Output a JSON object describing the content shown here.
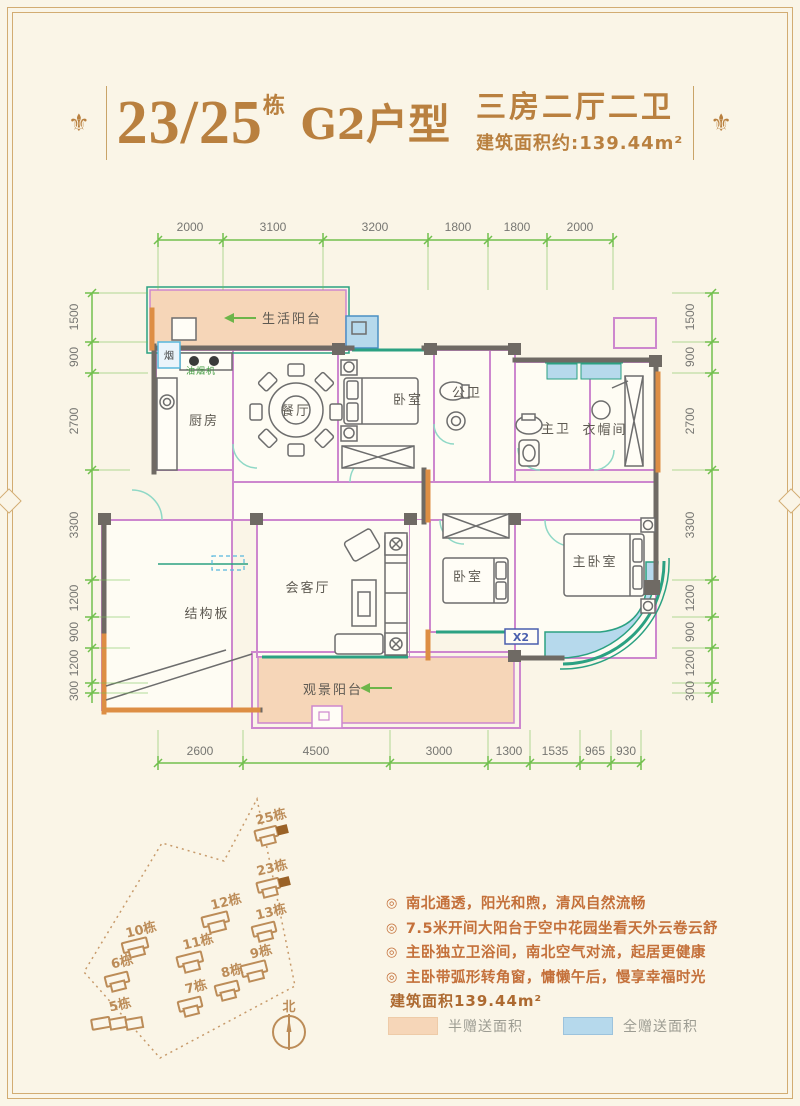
{
  "title": {
    "ornament": "⚜",
    "building_no": "23/25",
    "building_unit": "栋",
    "type_name": "G2户型",
    "layout": "三房二厅二卫",
    "area": "建筑面积约:139.44m²"
  },
  "dims": {
    "top": [
      "2000",
      "3100",
      "3200",
      "1800",
      "1800",
      "2000"
    ],
    "bottom": [
      "2600",
      "4500",
      "3000",
      "1300",
      "1535",
      "965",
      "930"
    ],
    "left": [
      "1500",
      "900",
      "2700",
      "3300",
      "1200",
      "900",
      "1200",
      "300"
    ],
    "right": [
      "1500",
      "900",
      "2700",
      "3300",
      "1200",
      "900",
      "1200",
      "300"
    ]
  },
  "plan": {
    "life_balcony": "生活阳台",
    "kitchen": "厨房",
    "dining": "餐厅",
    "bedroom_top": "卧室",
    "public_bath": "公卫",
    "master_bath": "主卫",
    "cloakroom": "衣帽间",
    "living_room": "会客厅",
    "structural_slab": "结构板",
    "bedroom_mid": "卧室",
    "master_bedroom": "主卧室",
    "view_balcony": "观景阳台",
    "range_hood": "油烟机",
    "flue": "烟",
    "window_mark": "X2"
  },
  "siteplan": {
    "north_label": "北",
    "buildings": [
      {
        "label": "25栋",
        "highlighted": true
      },
      {
        "label": "23栋",
        "highlighted": true
      },
      {
        "label": "12栋"
      },
      {
        "label": "13栋"
      },
      {
        "label": "10栋"
      },
      {
        "label": "11栋"
      },
      {
        "label": "9栋"
      },
      {
        "label": "8栋"
      },
      {
        "label": "6栋"
      },
      {
        "label": "7栋"
      },
      {
        "label": "5栋"
      }
    ]
  },
  "notes": {
    "bullet_icon": "◎",
    "bullets": [
      "南北通透，阳光和煦，清风自然流畅",
      "7.5米开间大阳台于空中花园坐看天外云卷云舒",
      "主卧独立卫浴间，南北空气对流，起居更健康",
      "主卧带弧形转角窗，慵懒午后，慢享幸福时光"
    ],
    "area_note": "建筑面积139.44m²"
  },
  "legend": {
    "items": [
      {
        "label": "半赠送面积",
        "color": "#f6d6b8"
      },
      {
        "label": "全赠送面积",
        "color": "#b6d9ec"
      }
    ]
  },
  "colors": {
    "background": "#faf5e7",
    "frame_gold": "#d2ac72",
    "title_bronze": "#b9803f",
    "dimension_green": "#72c04e",
    "wall_gray": "#6f6a64",
    "wall_orange": "#dd8e44",
    "partition_pink": "#cd87ce",
    "window_teal": "#2ba182",
    "site_brown": "#bc8c58",
    "bullet_orange": "#c4703a"
  }
}
